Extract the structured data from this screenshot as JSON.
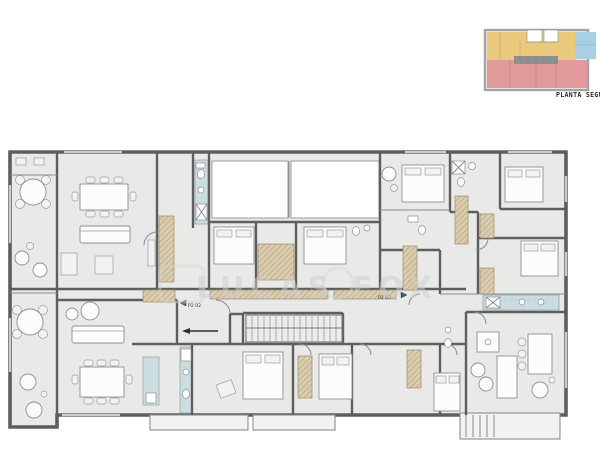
{
  "title": {
    "text": "PLANTA SEGUNDA"
  },
  "watermark": {
    "text": "LUCAS FOX"
  },
  "units": {
    "left": "P2 02",
    "right": "P2 03"
  },
  "colors": {
    "floor": "#e9e9e8",
    "wall": "#5e5e5e",
    "bathroom": "#ccdde1",
    "closet": "#dbccae",
    "lightwell": "#ffffff",
    "balcony": "#f2f2f1",
    "key_yellow": "#eac87c",
    "key_blue": "#a9cfe4",
    "key_red": "#e1999a",
    "key_gray": "#8f8f8f"
  }
}
